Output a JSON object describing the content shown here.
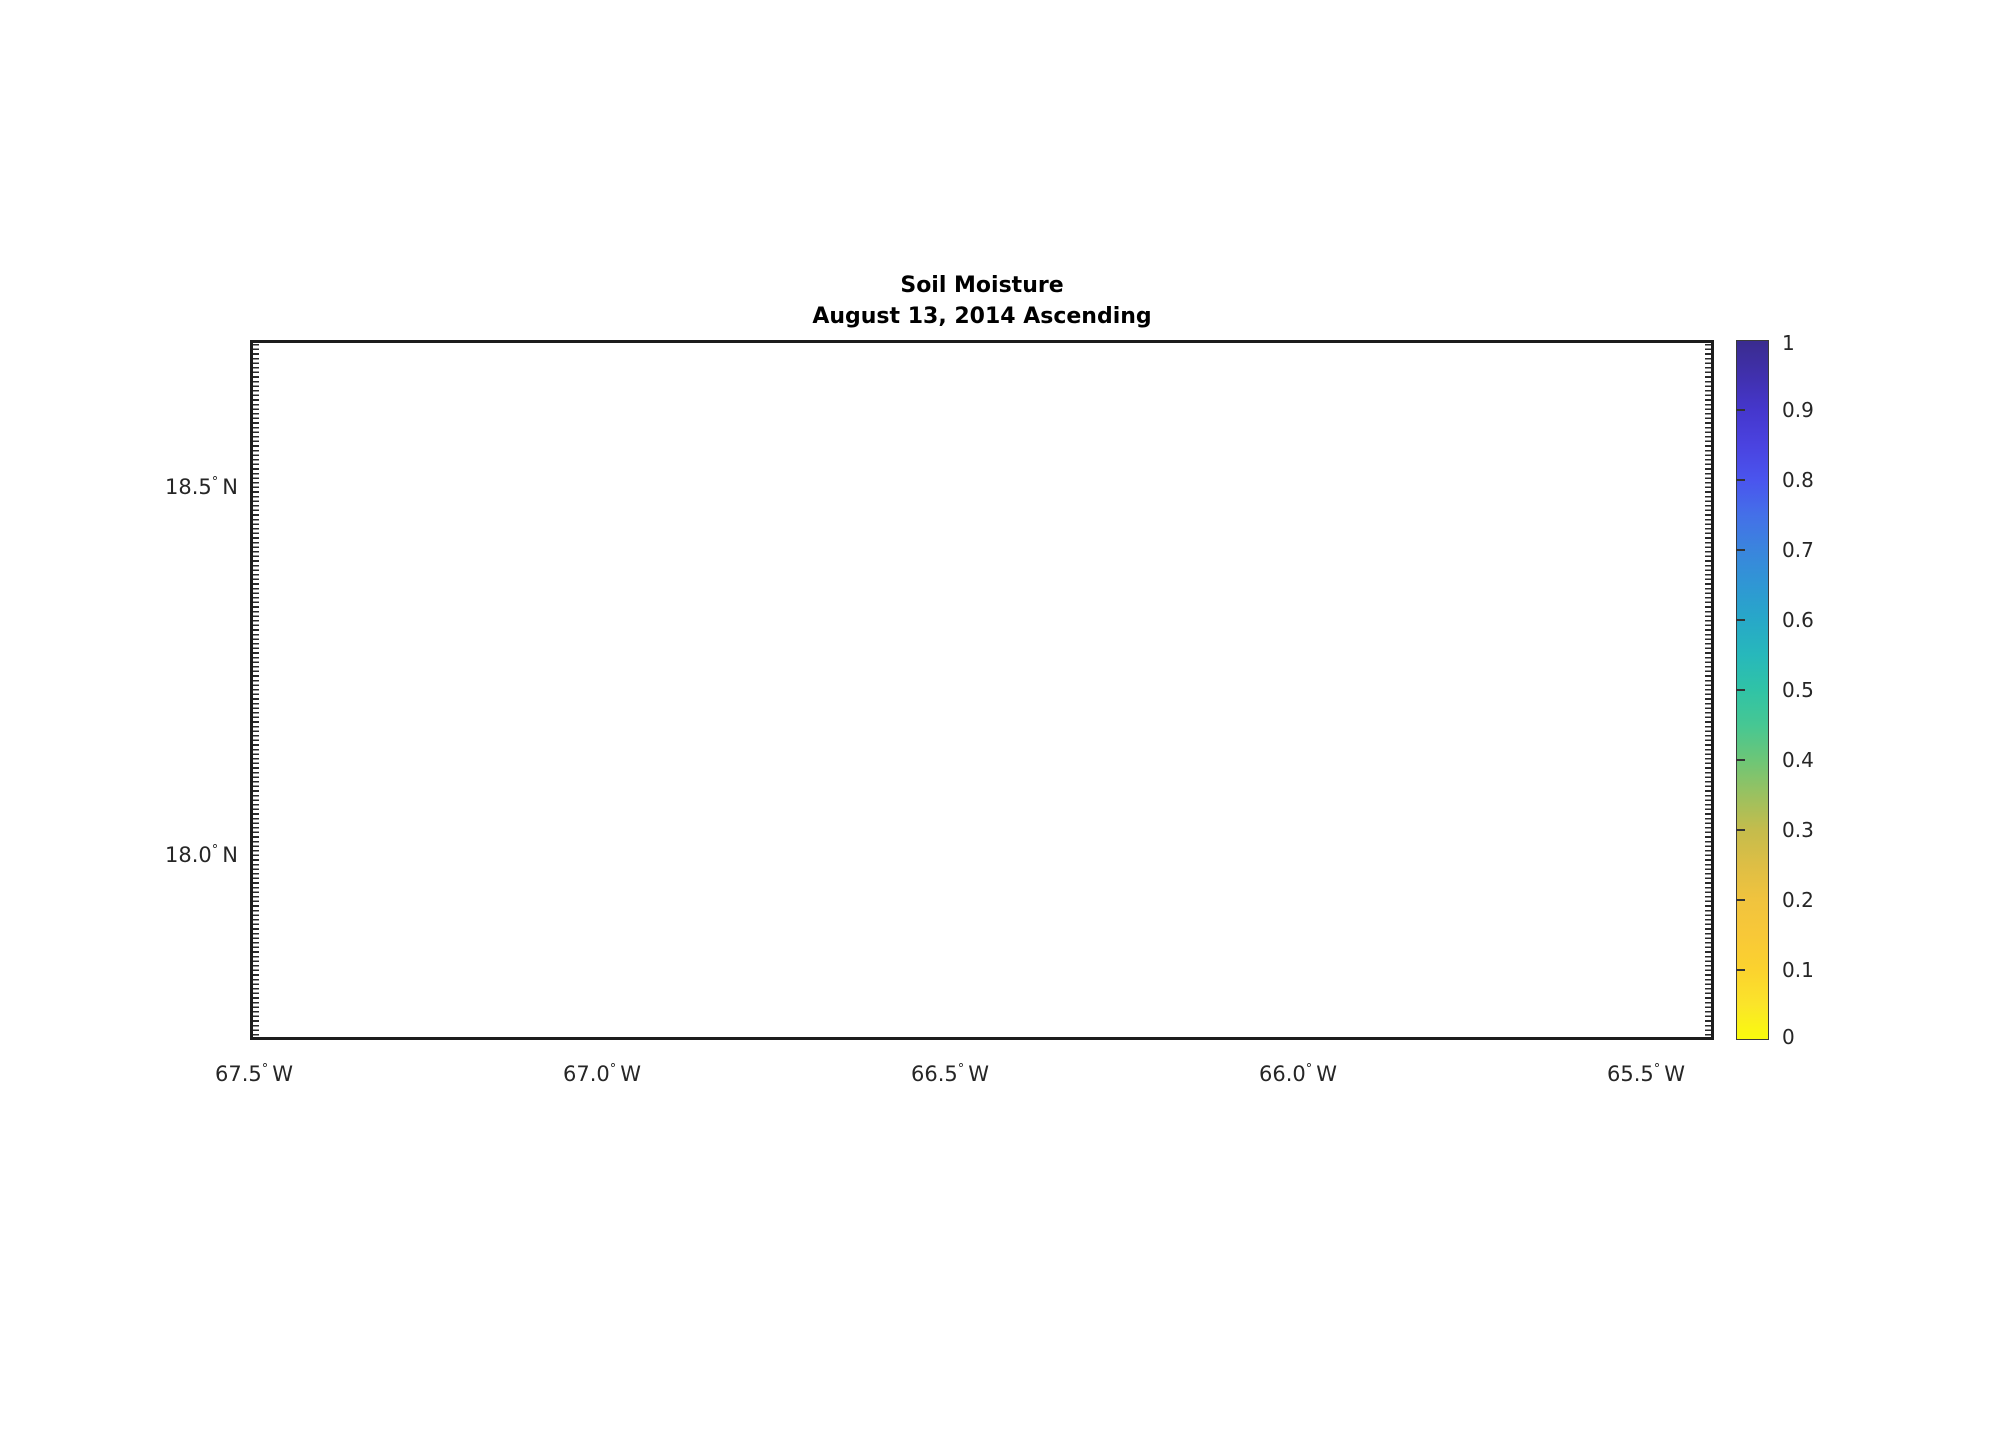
{
  "title": {
    "line1": "Soil Moisture",
    "line2": "August 13, 2014 Ascending"
  },
  "axes": {
    "degree": "°",
    "x_ticks": [
      {
        "value": "67.5",
        "unit": "W"
      },
      {
        "value": "67.0",
        "unit": "W"
      },
      {
        "value": "66.5",
        "unit": "W"
      },
      {
        "value": "66.0",
        "unit": "W"
      },
      {
        "value": "65.5",
        "unit": "W"
      }
    ],
    "y_ticks": [
      {
        "value": "18.5",
        "unit": "N"
      },
      {
        "value": "18.0",
        "unit": "N"
      }
    ],
    "grid_color": "#cfcfcf"
  },
  "colorbar": {
    "tick_labels": [
      "1",
      "0.9",
      "0.8",
      "0.7",
      "0.6",
      "0.5",
      "0.4",
      "0.3",
      "0.2",
      "0.1",
      "0"
    ],
    "stops": [
      {
        "pos": 0.0,
        "color": "#f9fb0d"
      },
      {
        "pos": 0.05,
        "color": "#fbe42a"
      },
      {
        "pos": 0.1,
        "color": "#fbd22e"
      },
      {
        "pos": 0.15,
        "color": "#f8c838"
      },
      {
        "pos": 0.2,
        "color": "#f0c33e"
      },
      {
        "pos": 0.25,
        "color": "#ddbe45"
      },
      {
        "pos": 0.3,
        "color": "#c4bc4c"
      },
      {
        "pos": 0.35,
        "color": "#9ac160"
      },
      {
        "pos": 0.4,
        "color": "#6cc677"
      },
      {
        "pos": 0.45,
        "color": "#46c793"
      },
      {
        "pos": 0.5,
        "color": "#30c3a6"
      },
      {
        "pos": 0.55,
        "color": "#27b8bb"
      },
      {
        "pos": 0.6,
        "color": "#27a8c8"
      },
      {
        "pos": 0.65,
        "color": "#2f97d4"
      },
      {
        "pos": 0.7,
        "color": "#3a85dd"
      },
      {
        "pos": 0.75,
        "color": "#4470e8"
      },
      {
        "pos": 0.8,
        "color": "#4a55ee"
      },
      {
        "pos": 0.85,
        "color": "#4a43e0"
      },
      {
        "pos": 0.9,
        "color": "#4537cd"
      },
      {
        "pos": 0.95,
        "color": "#4030ad"
      },
      {
        "pos": 1.0,
        "color": "#3a2c8f"
      }
    ]
  },
  "map": {
    "island_color": "#9d9d9d",
    "dot_color": "rgba(120,120,120,0.28)",
    "band_stroke_color": "#f5d438",
    "band_strips": [
      {
        "color": "#f2df2d"
      },
      {
        "color": "#f7c83e"
      },
      {
        "color": "#f5d036"
      },
      {
        "color": "#f7ca3e"
      },
      {
        "color": "#efe42a"
      }
    ]
  },
  "chart_data": {
    "type": "heatmap",
    "title": "Soil Moisture — August 13, 2014 Ascending",
    "region": "Puerto Rico (gray island mask = no retrieval)",
    "xlabel": "Longitude",
    "ylabel": "Latitude",
    "x_tick_labels": [
      "67.5° W",
      "67.0° W",
      "66.5° W",
      "66.0° W",
      "65.5° W"
    ],
    "y_tick_labels": [
      "18.5° N",
      "18.0° N"
    ],
    "xlim_deg_west": [
      67.51,
      65.4
    ],
    "ylim_deg_north": [
      17.75,
      18.7
    ],
    "grid": "dotted",
    "island_extent": {
      "lon_west": -67.29,
      "lon_east": -65.58,
      "lat_south": 17.91,
      "lat_north": 18.52
    },
    "colorbar": {
      "label": "soil moisture (fraction)",
      "range": [
        0,
        1
      ],
      "ticks": [
        0,
        0.1,
        0.2,
        0.3,
        0.4,
        0.5,
        0.6,
        0.7,
        0.8,
        0.9,
        1
      ],
      "colormap": "parula reversed (yellow low, indigo high)",
      "position": "right"
    },
    "swath": {
      "description": "East-west retrieval band of five grid-cell strips across island interior",
      "lat_range": [
        18.19,
        18.42
      ],
      "strips": [
        {
          "lon_from": -67.16,
          "lon_to": -66.91,
          "soil_moisture": 0.05
        },
        {
          "lon_from": -66.91,
          "lon_to": -66.66,
          "soil_moisture": 0.14
        },
        {
          "lon_from": -66.66,
          "lon_to": -66.41,
          "soil_moisture": 0.1
        },
        {
          "lon_from": -66.41,
          "lon_to": -66.16,
          "soil_moisture": 0.13
        },
        {
          "lon_from": -66.16,
          "lon_to": -65.9,
          "soil_moisture": 0.04
        }
      ]
    }
  }
}
